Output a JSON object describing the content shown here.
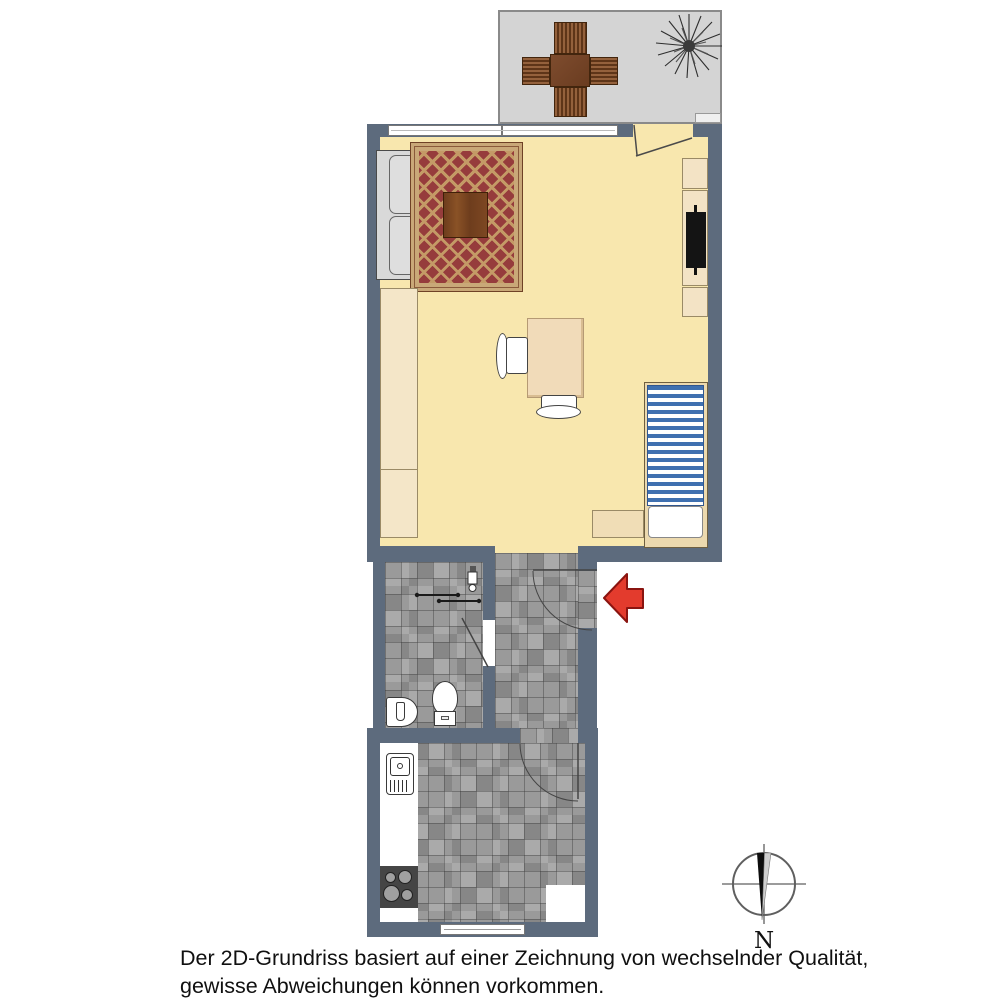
{
  "caption": {
    "line1": "Der 2D-Grundriss basiert auf einer Zeichnung von wechselnder Qualität,",
    "line2": "gewisse Abweichungen können vorkommen."
  },
  "compass": {
    "label": "N"
  },
  "colors": {
    "wall": "#5d6b7d",
    "living_floor": "#f8e7ae",
    "balcony_floor": "#d4d4d4",
    "tile_gray": "#9a9a9a",
    "rug_red": "#963c3c",
    "rug_lattice_tan": "#c49a66",
    "wood_brown": "#7b4a2e",
    "bed_stripe_blue": "#3f70b0",
    "cabinet_cream": "#f3e3c5",
    "entry_arrow_red": "#e33b2d"
  },
  "items": [
    "balcony",
    "patio-table",
    "plant",
    "window",
    "balcony-door",
    "sofa",
    "rug",
    "coffee-table",
    "shelf-cabinet",
    "tv",
    "wardrobe",
    "dining-table",
    "dining-chairs",
    "bed",
    "nightstand",
    "bathroom",
    "shower-rail",
    "toilet",
    "washbasin",
    "hallway",
    "entrance-door",
    "entrance-arrow",
    "kitchen",
    "kitchen-sink",
    "stove",
    "kitchen-window",
    "compass-rose"
  ]
}
